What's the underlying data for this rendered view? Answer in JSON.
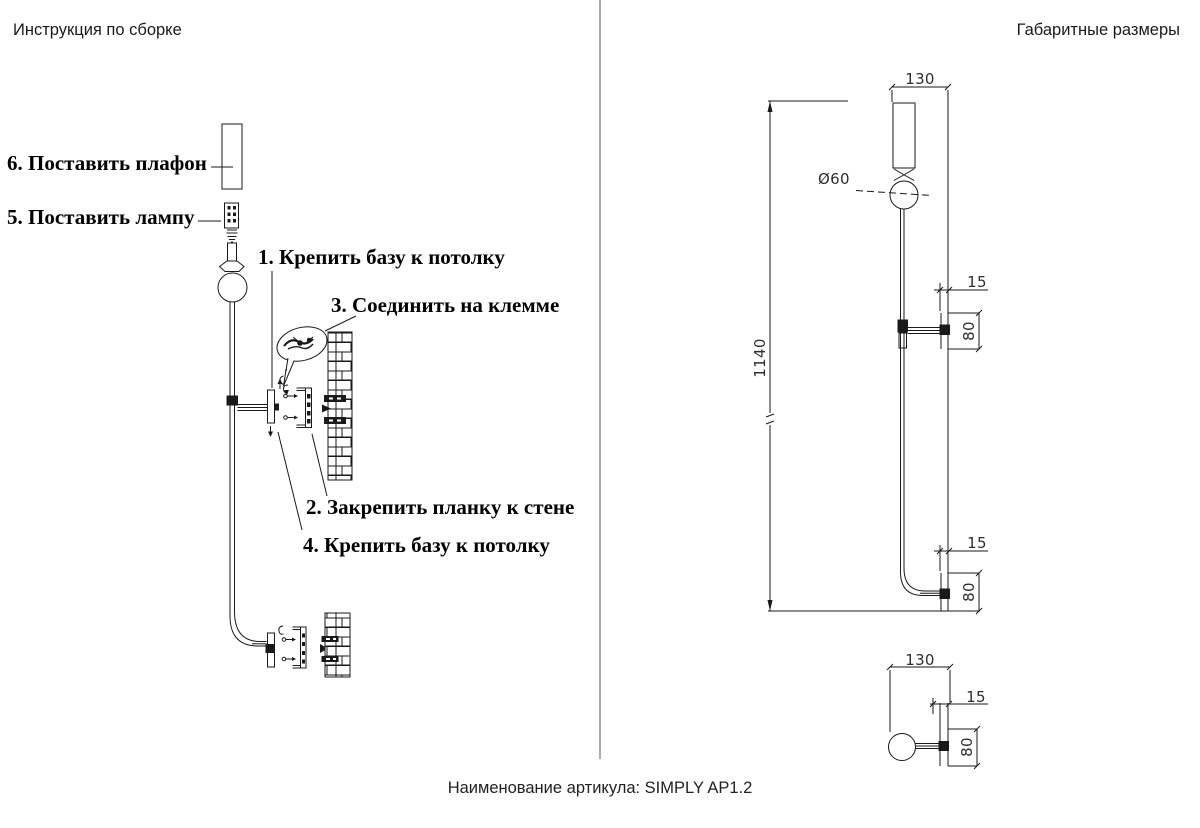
{
  "page": {
    "left_panel_title": "Инструкция по сборке",
    "right_panel_title": "Габаритные размеры",
    "caption": "Наименование артикула: SIMPLY AP1.2"
  },
  "steps": {
    "step1": "1. Крепить базу к потолку",
    "step2": "2. Закрепить планку к стене",
    "step3": "3. Соединить на клемме",
    "step4": "4. Крепить базу к потолку",
    "step5": "5. Поставить лампу",
    "step6": "6. Поставить плафон"
  },
  "dimensions": {
    "shade_width": "130",
    "sphere_diameter": "Ø60",
    "total_height": "1140",
    "bracket_offset_mid": "15",
    "bracket_height_mid": "80",
    "bracket_offset_low": "15",
    "bracket_height_low": "80",
    "base_width_bottom": "130",
    "bracket_offset_bottom": "15",
    "bracket_height_bottom": "80"
  },
  "colors": {
    "line": "#1a1a1a",
    "text": "#000000"
  }
}
